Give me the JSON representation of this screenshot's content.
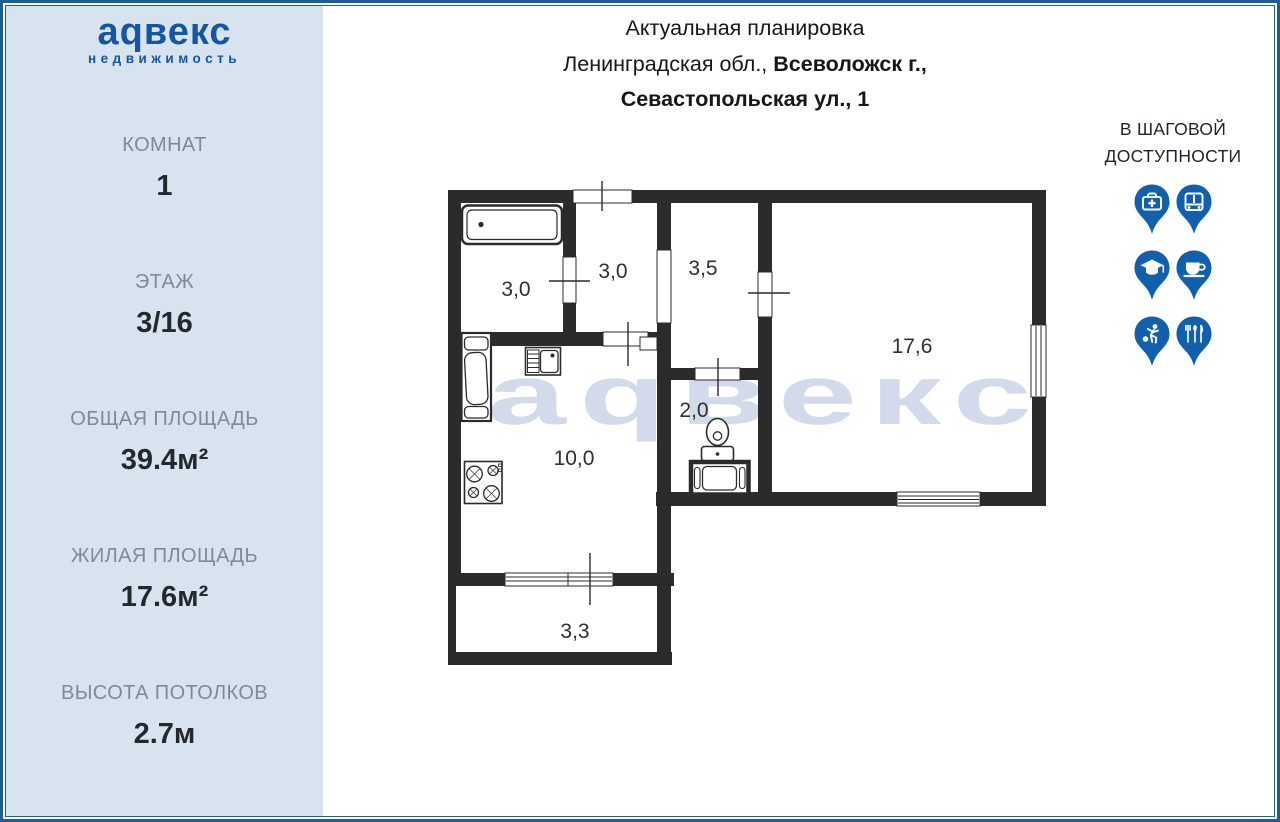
{
  "brand": {
    "logo": "аqвекс",
    "tagline": "недвижимость"
  },
  "sidebar": {
    "stats": [
      {
        "label": "КОМНАТ",
        "value": "1"
      },
      {
        "label": "ЭТАЖ",
        "value": "3/16"
      },
      {
        "label": "ОБЩАЯ ПЛОЩАДЬ",
        "value": "39.4м²"
      },
      {
        "label": "ЖИЛАЯ ПЛОЩАДЬ",
        "value": "17.6м²"
      },
      {
        "label": "ВЫСОТА ПОТОЛКОВ",
        "value": "2.7м"
      }
    ]
  },
  "header": {
    "title": "Актуальная планировка",
    "address_prefix": "Ленинградская обл., ",
    "address_city": "Всеволожск г.,",
    "address_street": "Севастопольская ул., 1"
  },
  "nearby": {
    "title_line1": "В ШАГОВОЙ",
    "title_line2": "ДОСТУПНОСТИ",
    "icons": [
      "medicine",
      "transport",
      "education",
      "cafe",
      "sport",
      "restaurant"
    ]
  },
  "plan": {
    "watermark": "аqвекс",
    "rooms": {
      "bathroom": "3,0",
      "hall_small": "3,0",
      "hallway": "3,5",
      "living_room": "17,6",
      "wc": "2,0",
      "kitchen": "10,0",
      "balcony": "3,3"
    }
  },
  "colors": {
    "accent_blue": "#1456a4",
    "pin_blue": "#1160ae",
    "sidebar_bg": "#d7e4f0",
    "frame_blue": "#1f5d92",
    "wall": "#2b2b2b",
    "watermark": "#d2daec"
  }
}
